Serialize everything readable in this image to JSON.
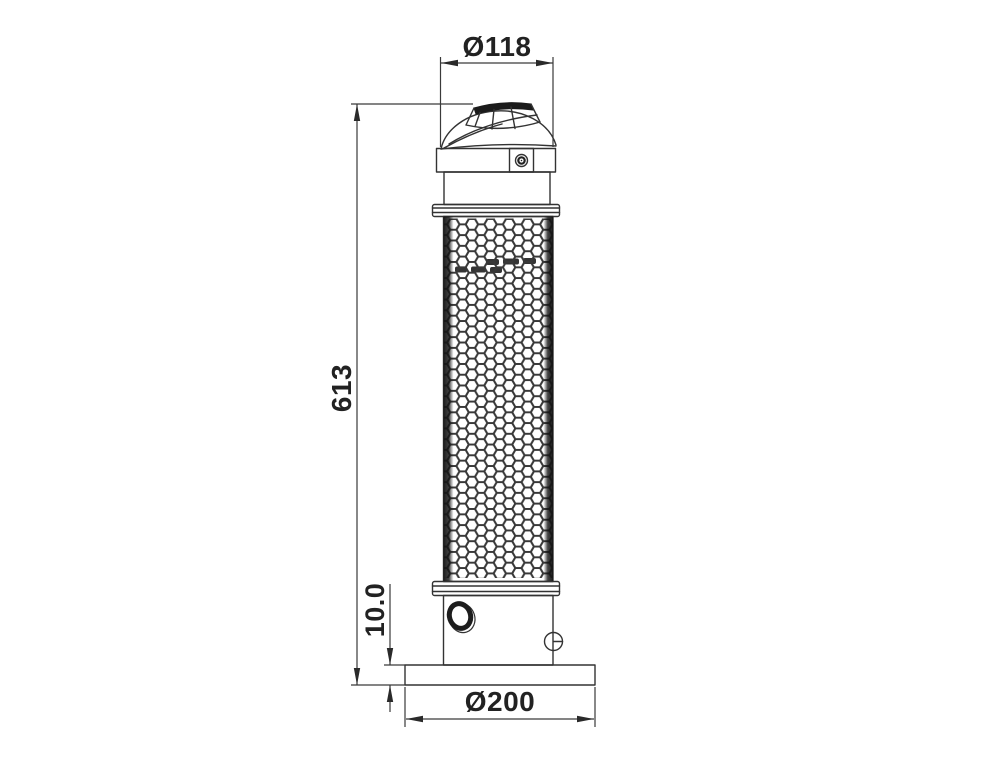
{
  "drawing": {
    "type": "technical-dimension-drawing",
    "background_color": "#ffffff",
    "line_color": "#333333",
    "text_color": "#222222",
    "dimensions": {
      "top_diameter": {
        "label": "Ø118",
        "value": 118
      },
      "overall_height": {
        "label": "613",
        "value": 613
      },
      "base_plate_thickness": {
        "label": "10.0",
        "value": 10.0
      },
      "base_diameter": {
        "label": "Ø200",
        "value": 200
      }
    }
  }
}
